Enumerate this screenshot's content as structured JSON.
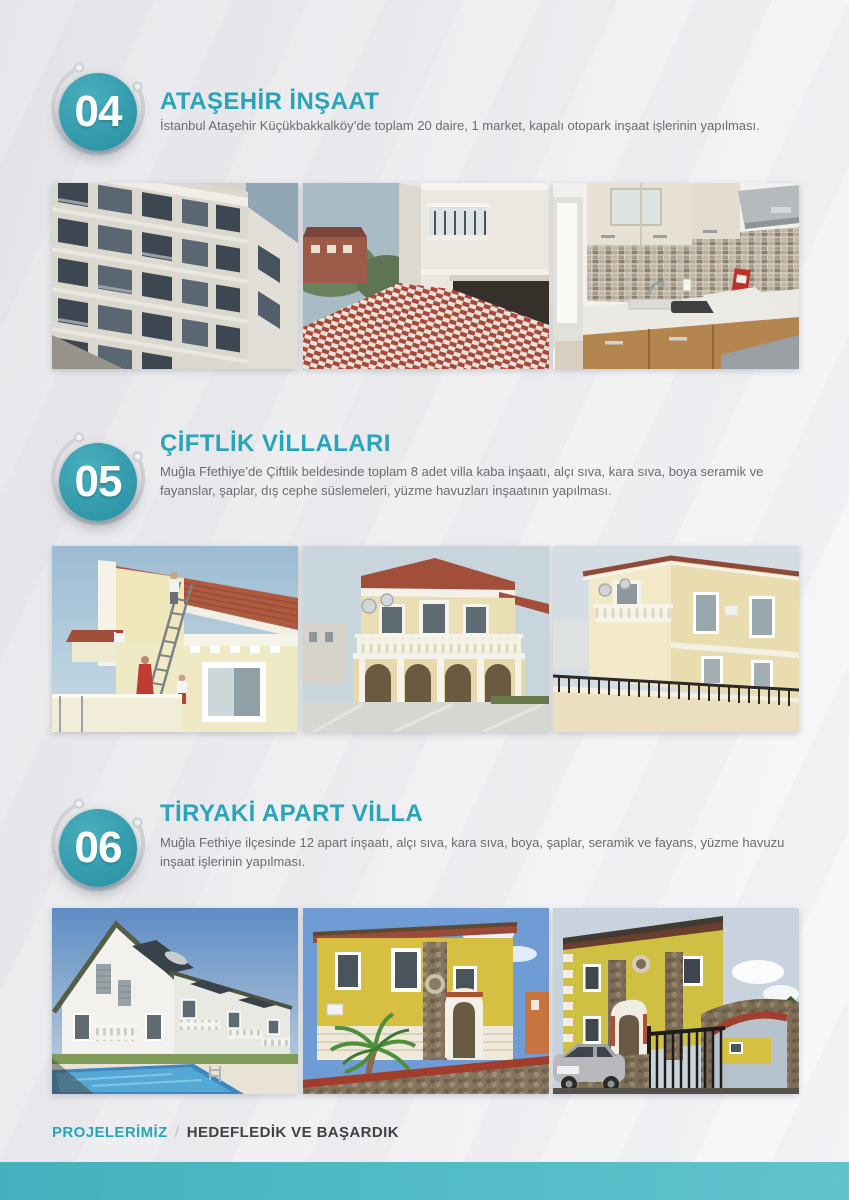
{
  "page": {
    "accent_teal": "#2aa4b7",
    "badge_teal": "#39a4b4",
    "text_gray": "#6b6c6e",
    "footer_dark": "#414042",
    "bottom_bar_teal": "#4fbac5"
  },
  "sections": [
    {
      "number": "04",
      "title": "ATAŞEHİR İNŞAAT",
      "description": "İstanbul Ataşehir Küçükbakkalköy’de toplam 20 daire, 1 market, kapalı otopark inşaat işlerinin yapılması.",
      "photos": [
        "apartment-facade-photo",
        "building-entrance-photo",
        "kitchen-interior-photo"
      ]
    },
    {
      "number": "05",
      "title": "ÇİFTLİK VİLLALARI",
      "description": "Muğla Ffethiye’de Çiftlik beldesinde toplam 8 adet villa kaba inşaatı, alçı sıva, kara sıva, boya seramik ve fayanslar, şaplar, dış cephe süslemeleri, yüzme havuzları inşaatının yapılması.",
      "photos": [
        "villa-painting-photo",
        "villa-front-photo",
        "villa-corner-photo"
      ]
    },
    {
      "number": "06",
      "title": "TİRYAKİ APART VİLLA",
      "description": "Muğla Fethiye ilçesinde 12 apart inşaatı, alçı sıva, kara sıva, boya, şaplar, seramik ve fayans, yüzme havuzu inşaat işlerinin yapılması.",
      "photos": [
        "apartments-pool-photo",
        "yellow-villa-photo",
        "yellow-duplex-photo"
      ]
    }
  ],
  "footer": {
    "brand": "PROJELERİMİZ",
    "separator": "/",
    "tagline": "HEDEFLEDİK VE BAŞARDIK"
  }
}
